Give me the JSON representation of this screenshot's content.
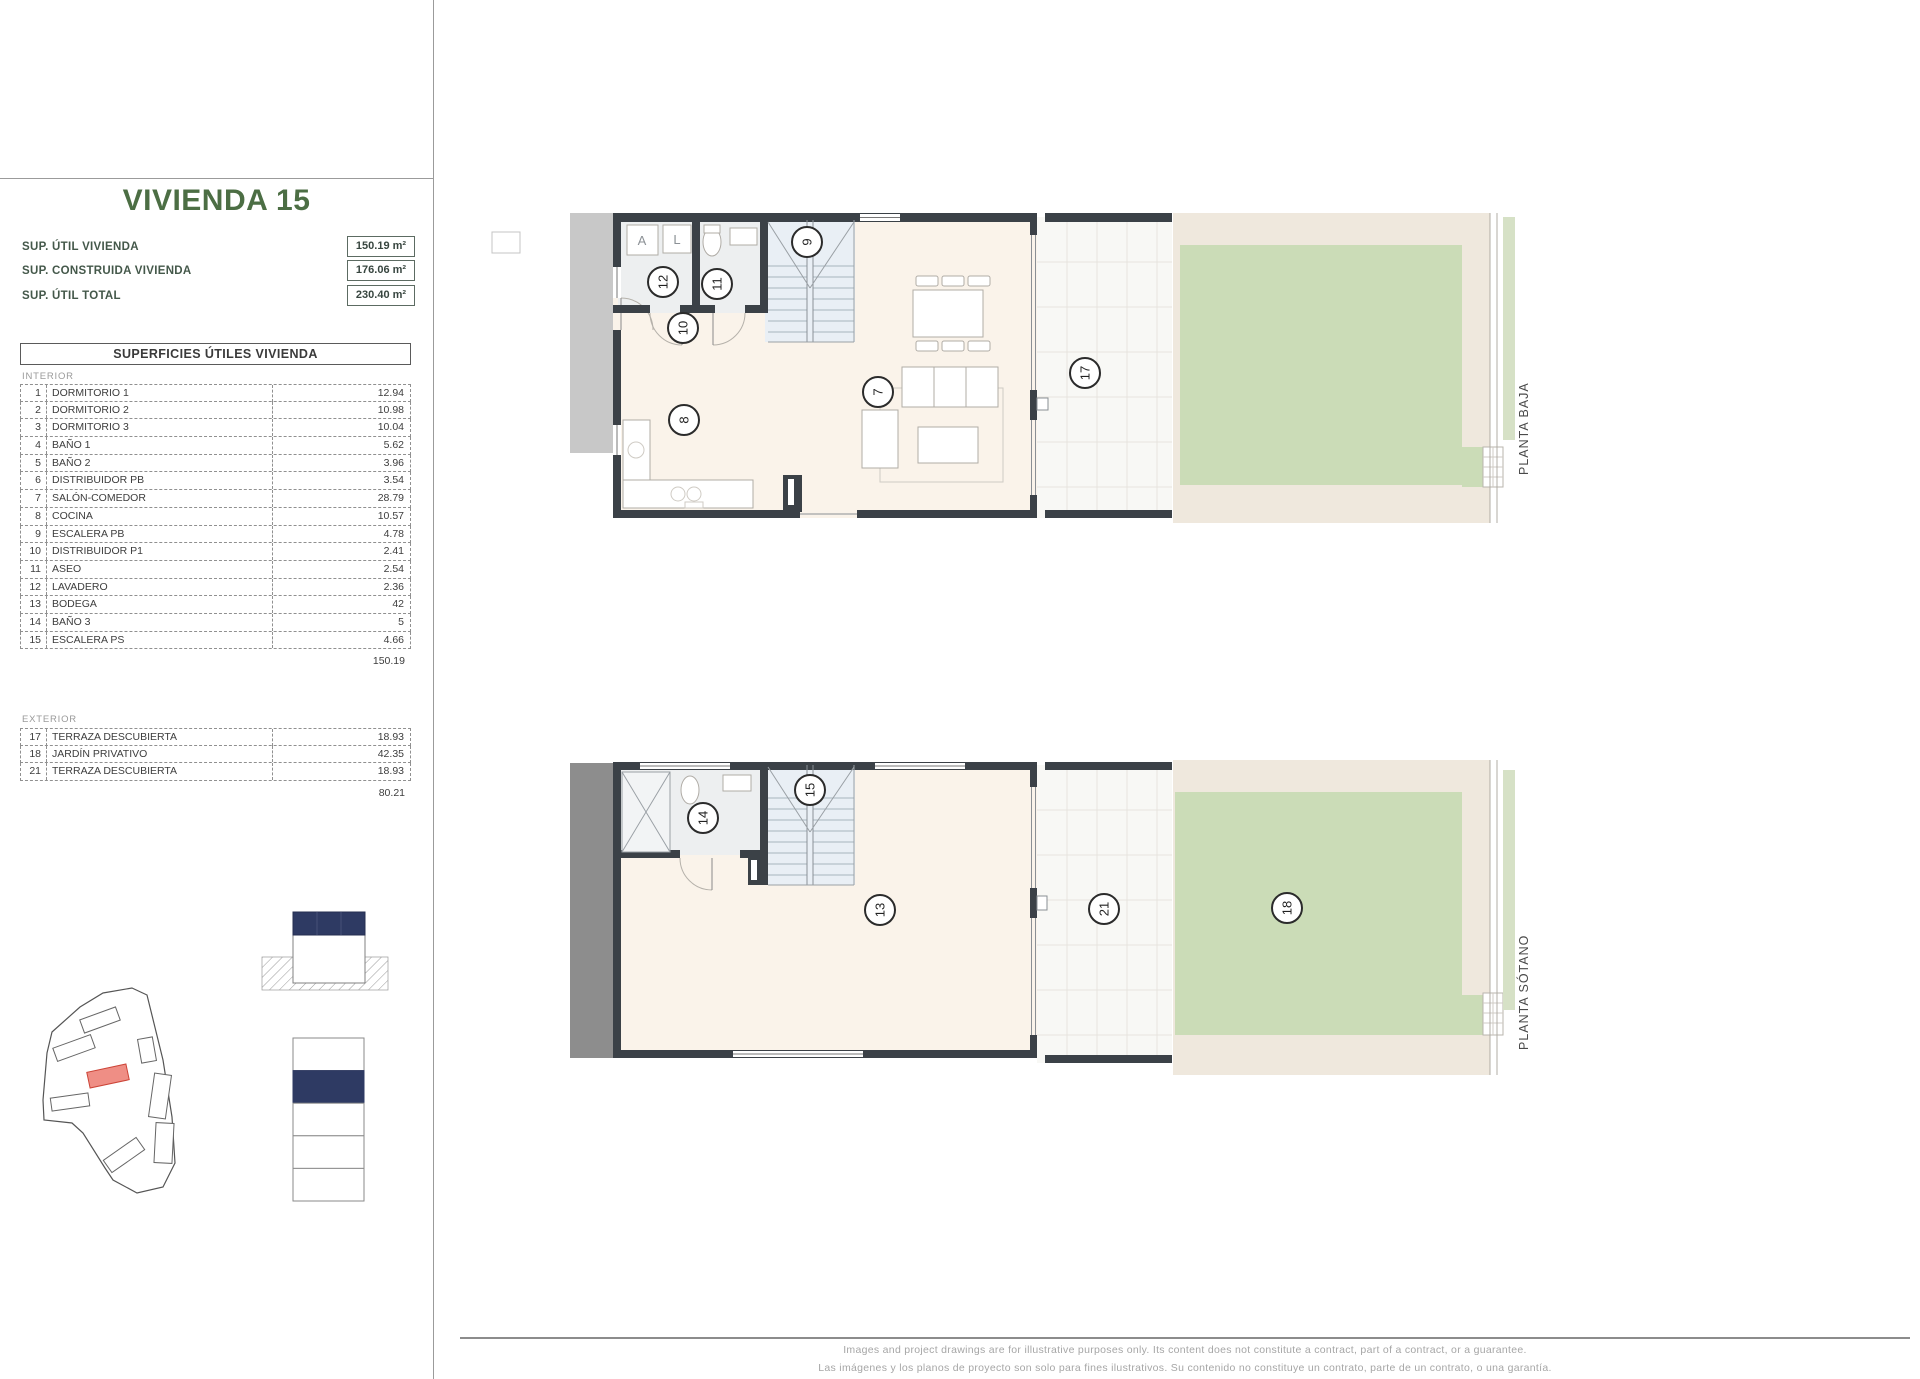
{
  "title": "VIVIENDA 15",
  "stats": {
    "rows": [
      {
        "label": "SUP. ÚTIL VIVIENDA",
        "value": "150.19 m²"
      },
      {
        "label": "SUP. CONSTRUIDA VIVIENDA",
        "value": "176.06 m²"
      },
      {
        "label": "SUP. ÚTIL TOTAL",
        "value": "230.40 m²"
      }
    ]
  },
  "areas_table": {
    "header": "SUPERFICIES ÚTILES VIVIENDA",
    "interior": {
      "section_label": "INTERIOR",
      "rows": [
        {
          "num": "1",
          "name": "DORMITORIO 1",
          "value": "12.94"
        },
        {
          "num": "2",
          "name": "DORMITORIO 2",
          "value": "10.98"
        },
        {
          "num": "3",
          "name": "DORMITORIO 3",
          "value": "10.04"
        },
        {
          "num": "4",
          "name": "BAÑO 1",
          "value": "5.62"
        },
        {
          "num": "5",
          "name": "BAÑO 2",
          "value": "3.96"
        },
        {
          "num": "6",
          "name": "DISTRIBUIDOR PB",
          "value": "3.54"
        },
        {
          "num": "7",
          "name": "SALÓN-COMEDOR",
          "value": "28.79"
        },
        {
          "num": "8",
          "name": "COCINA",
          "value": "10.57"
        },
        {
          "num": "9",
          "name": "ESCALERA PB",
          "value": "4.78"
        },
        {
          "num": "10",
          "name": "DISTRIBUIDOR P1",
          "value": "2.41"
        },
        {
          "num": "11",
          "name": "ASEO",
          "value": "2.54"
        },
        {
          "num": "12",
          "name": "LAVADERO",
          "value": "2.36"
        },
        {
          "num": "13",
          "name": "BODEGA",
          "value": "42"
        },
        {
          "num": "14",
          "name": "BAÑO 3",
          "value": "5"
        },
        {
          "num": "15",
          "name": "ESCALERA PS",
          "value": "4.66"
        }
      ],
      "total": "150.19"
    },
    "exterior": {
      "section_label": "EXTERIOR",
      "rows": [
        {
          "num": "17",
          "name": "TERRAZA DESCUBIERTA",
          "value": "18.93"
        },
        {
          "num": "18",
          "name": "JARDÍN PRIVATIVO",
          "value": "42.35"
        },
        {
          "num": "21",
          "name": "TERRAZA DESCUBIERTA",
          "value": "18.93"
        }
      ],
      "total": "80.21"
    }
  },
  "plans": {
    "baja": {
      "label": "PLANTA BAJA",
      "tags": {
        "stairs": "9",
        "laundry": "12",
        "bath": "11",
        "hall": "10",
        "kitchen": "8",
        "living": "7",
        "terrace": "17"
      },
      "appliances": {
        "appliance_a": "A",
        "appliance_l": "L"
      }
    },
    "sotano": {
      "label": "PLANTA SÓTANO",
      "tags": {
        "stairs": "15",
        "bath": "14",
        "cellar": "13",
        "terrace": "21",
        "garden": "18"
      }
    }
  },
  "footer": {
    "line1": "Images and project drawings are for illustrative purposes only. Its content does not constitute a contract, part of a contract, or a guarantee.",
    "line2": "Las imágenes y los planos de proyecto son solo para fines ilustrativos. Su contenido no constituye un contrato, parte de un contrato, o una garantía."
  },
  "colors": {
    "accent_green": "#4c6e44",
    "navy": "#2e3a63",
    "highlight_red": "#ef8e85",
    "garden_green": "#cbdcb7",
    "wall": "#3b4147"
  }
}
